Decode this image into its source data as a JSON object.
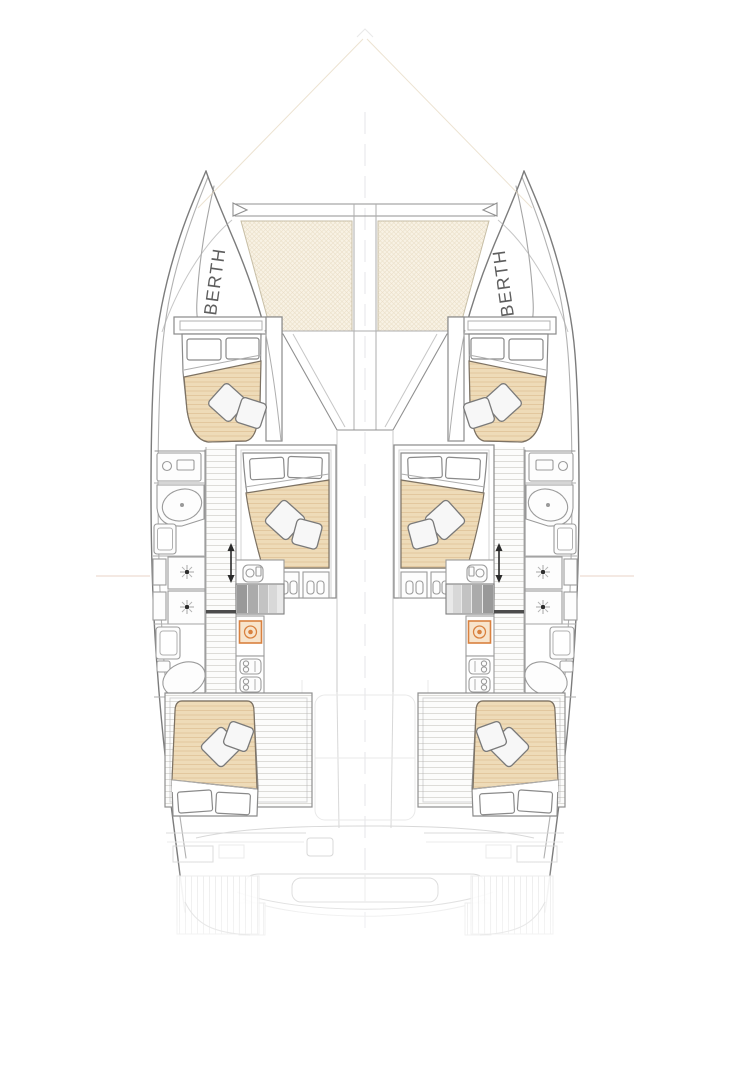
{
  "meta": {
    "title": "Catamaran interior deck plan"
  },
  "diagram": {
    "type": "yacht-floor-plan",
    "view": "top-down",
    "labels": {
      "port_berth": "BERTH",
      "starboard_berth": "BERTH"
    },
    "colors": {
      "bedding": "#eedbb8",
      "bedding_stripe": "#e2c79e",
      "trampoline": "#f8f2e4",
      "trampoline_grid": "#eadfc8",
      "outline": "#7c7c7c",
      "accent_orange": "#d9813f",
      "accent_orange_fill": "#f7e4cc",
      "label_text": "#4d4d4d",
      "reference_line": "#eedcd2"
    },
    "legend": {
      "icons": [
        "double-bed-icon",
        "pillow-icon",
        "shower-icon",
        "toilet-icon",
        "sink-icon",
        "stove-icon",
        "stairs-direction-arrow-icon",
        "companionway-steps-icon",
        "trampoline-mesh-icon",
        "forward-crossbeam-icon"
      ]
    },
    "counts": {
      "double_beds": 6,
      "bow_berths": 2,
      "showers": 2,
      "toilets": 2
    }
  }
}
